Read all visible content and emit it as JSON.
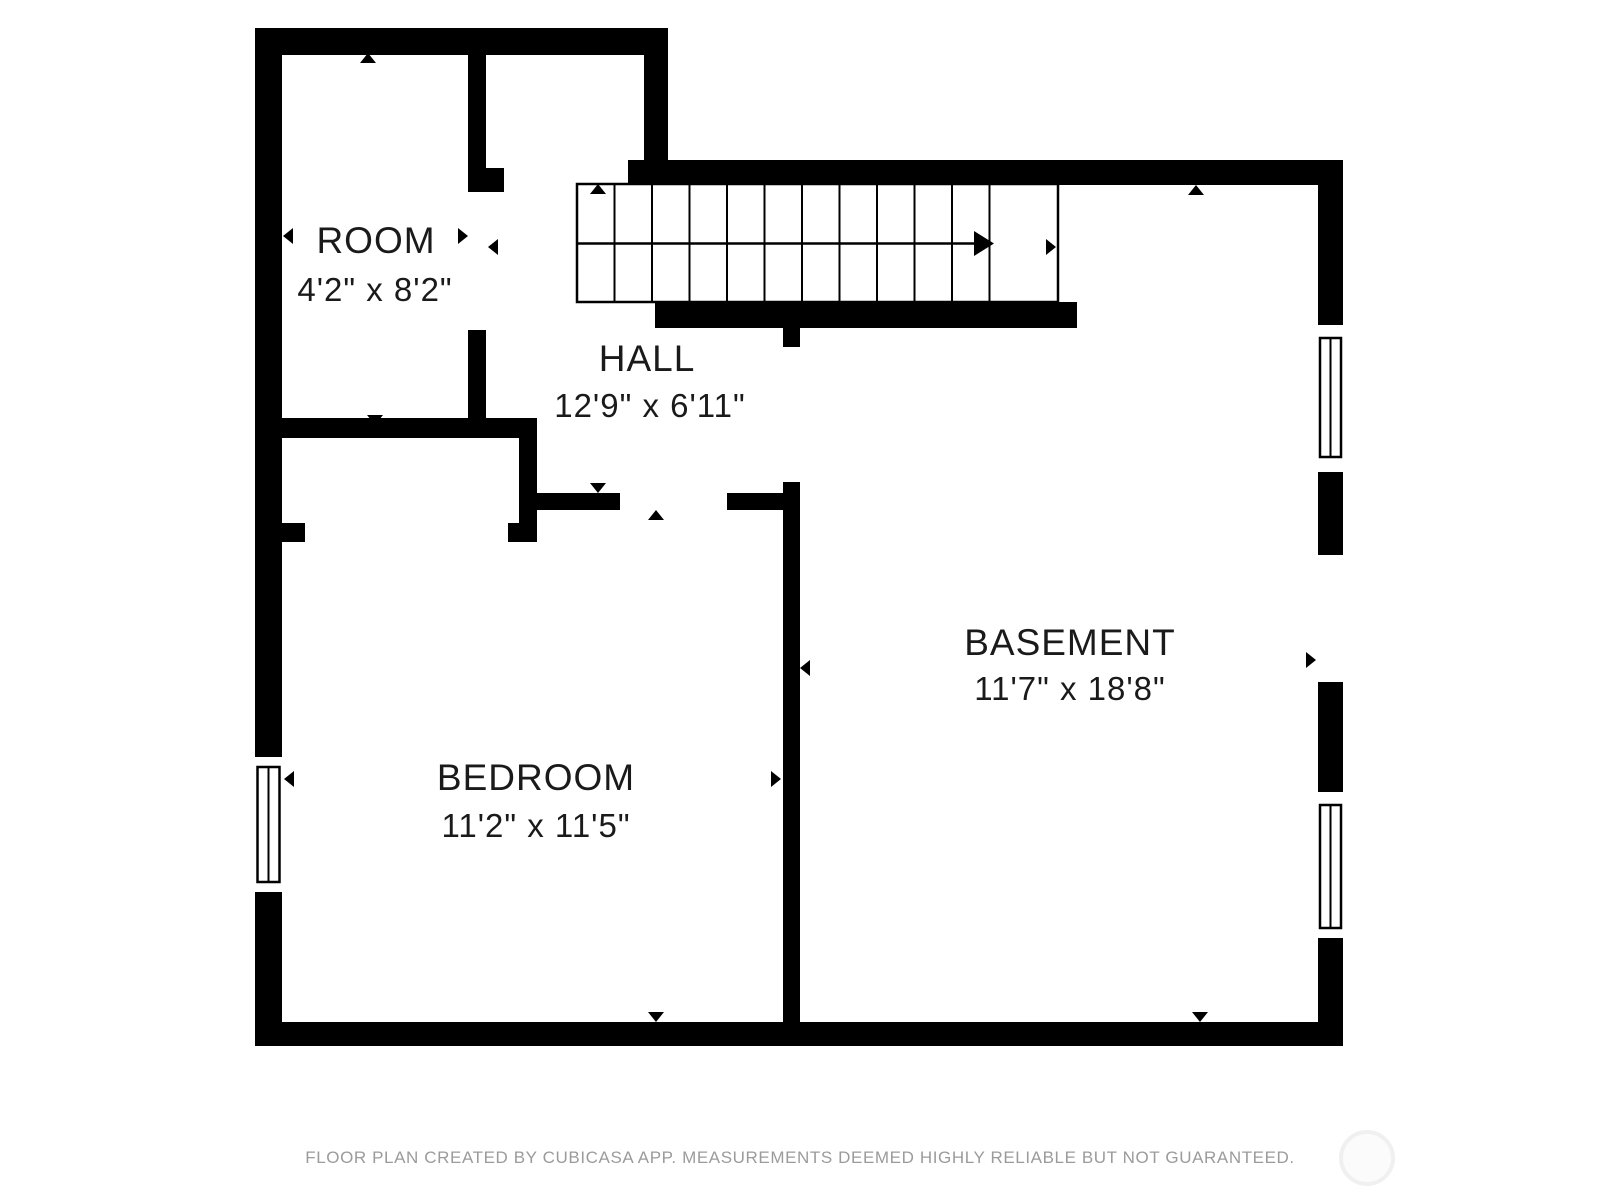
{
  "document": {
    "type": "floor-plan",
    "background": "#ffffff"
  },
  "colors": {
    "wall": "#000000",
    "label_text": "#1a1a1a",
    "footer_text": "#9b9b9b",
    "watermark_stroke": "#f0f0f0",
    "watermark_fill": "#fbfbfb"
  },
  "rooms": [
    {
      "name": "ROOM",
      "dimensions": "4'2\" x 8'2\""
    },
    {
      "name": "HALL",
      "dimensions": "12'9\" x 6'11\""
    },
    {
      "name": "BEDROOM",
      "dimensions": "11'2\" x 11'5\""
    },
    {
      "name": "BASEMENT",
      "dimensions": "11'7\" x 18'8\""
    }
  ],
  "stairs": {
    "treads": 11,
    "direction": "up-right"
  },
  "windows": {
    "count": 3
  },
  "footer": {
    "disclaimer": "FLOOR PLAN CREATED BY CUBICASA APP. MEASUREMENTS DEEMED HIGHLY RELIABLE BUT NOT GUARANTEED."
  }
}
